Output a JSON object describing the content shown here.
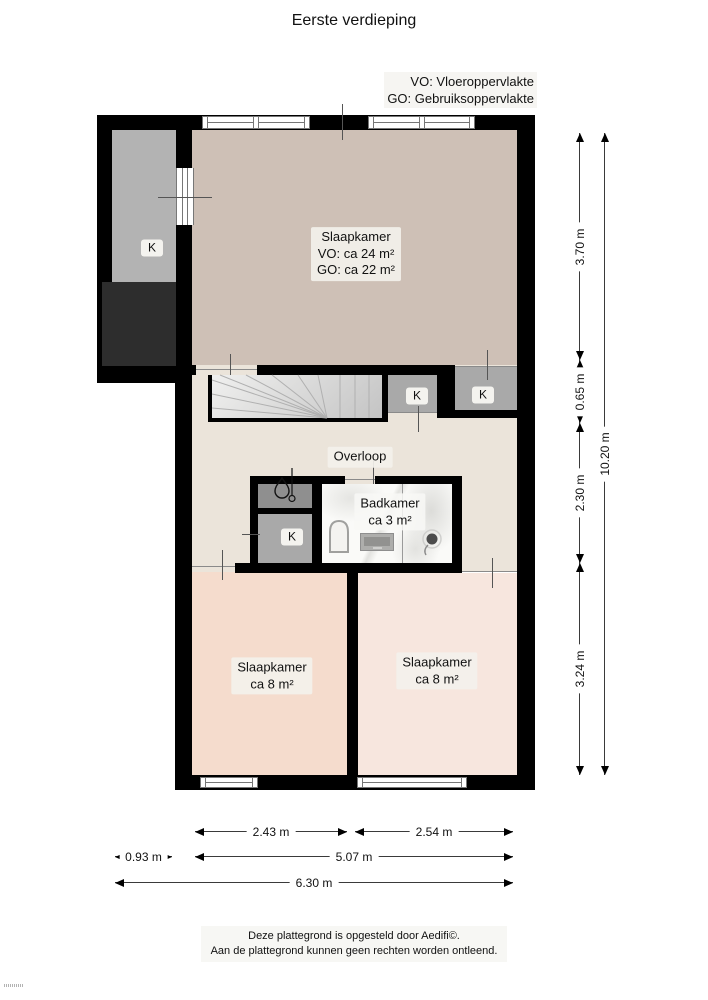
{
  "title": "Eerste verdieping",
  "legend": {
    "vo": "VO: Vloeroppervlakte",
    "go": "GO: Gebruiksoppervlakte"
  },
  "rooms": {
    "bedroom_main": {
      "name": "Slaapkamer",
      "vo": "VO: ca 24 m²",
      "go": "GO: ca 22 m²"
    },
    "landing": {
      "name": "Overloop"
    },
    "bathroom": {
      "name": "Badkamer",
      "area": "ca 3 m²"
    },
    "bedroom_left": {
      "name": "Slaapkamer",
      "area": "ca 8 m²"
    },
    "bedroom_right": {
      "name": "Slaapkamer",
      "area": "ca 8 m²"
    },
    "closet": {
      "label": "K"
    }
  },
  "dimensions": {
    "right": {
      "d1": "3.70 m",
      "d2": "0.65 m",
      "d3": "2.30 m",
      "d4": "3.24 m",
      "total": "10.20 m"
    },
    "bottom": {
      "d1": "2.43 m",
      "d2": "2.54 m",
      "d3": "0.93 m",
      "d4": "5.07 m",
      "total": "6.30 m"
    }
  },
  "footer": {
    "line1": "Deze plattegrond is opgesteld door Aedifi©.",
    "line2": "Aan de plattegrond kunnen geen rechten worden ontleend."
  },
  "colors": {
    "wall": "#000000",
    "bedroom_main_floor": "#cec0b6",
    "hall_floor": "#ebe4da",
    "bedroom_left_floor": "#f5dccd",
    "bedroom_right_floor": "#f7e6de",
    "closet_fill": "#a9a9a9",
    "attic_closet_fill": "#b3b3b3",
    "boiler_closet_fill": "#8f8f8f",
    "dark_storage_fill": "#2d2d2d"
  }
}
